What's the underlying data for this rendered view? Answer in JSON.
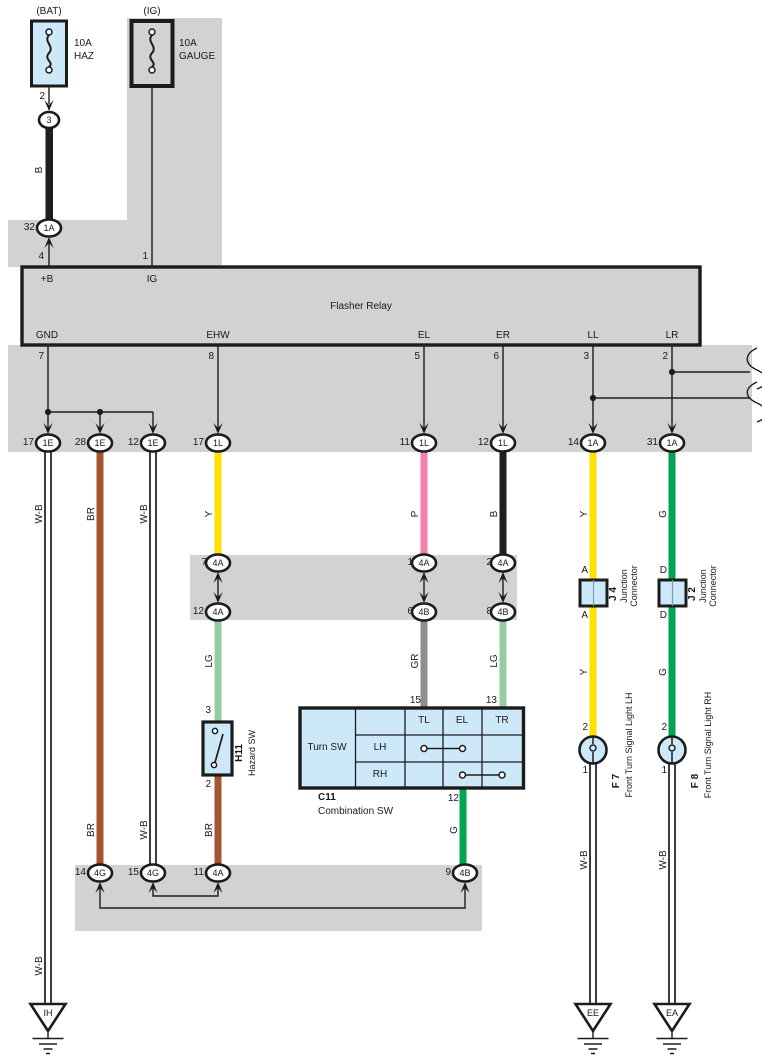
{
  "diagram": {
    "system": "Turn Signal and Hazard Warning wiring",
    "relay_title": "Flasher Relay"
  },
  "colors": {
    "panel": "#d2d2d2",
    "blue": "#cde9f9",
    "Y": "#ffe000",
    "P": "#f27fae",
    "B": "#1e1e1e",
    "BR": "#a4552d",
    "G": "#00a551",
    "LG": "#95cda1",
    "GR": "#8e8e8e"
  },
  "labels": [
    {
      "n": "fuse-bat-location",
      "t": "(BAT)",
      "x": 49,
      "y": 12
    },
    {
      "n": "fuse-ig-location",
      "t": "(IG)",
      "x": 152,
      "y": 12
    },
    {
      "n": "fuse-bat-rating",
      "t": "10A",
      "x": 74,
      "y": 44,
      "a": "s"
    },
    {
      "n": "fuse-bat-name",
      "t": "HAZ",
      "x": 74,
      "y": 57,
      "a": "s"
    },
    {
      "n": "fuse-ig-rating",
      "t": "10A",
      "x": 179,
      "y": 44,
      "a": "s"
    },
    {
      "n": "fuse-ig-name",
      "t": "GAUGE",
      "x": 179,
      "y": 57,
      "a": "s"
    },
    {
      "n": "pin-fuse-bat-2",
      "t": "2",
      "x": 45,
      "y": 97,
      "a": "e"
    },
    {
      "n": "conn-3-code",
      "t": "3",
      "x": 49,
      "y": 120,
      "fs": 9
    },
    {
      "n": "wire-b-label",
      "t": "B",
      "x": 40,
      "y": 170,
      "r": 1
    },
    {
      "n": "conn-1a-32-num",
      "t": "32",
      "x": 35,
      "y": 228,
      "a": "e"
    },
    {
      "n": "conn-1a-32-code",
      "t": "1A",
      "x": 49,
      "y": 228,
      "fs": 9
    },
    {
      "n": "pin-relay-4",
      "t": "4",
      "x": 44,
      "y": 257,
      "a": "e"
    },
    {
      "n": "pin-relay-1",
      "t": "1",
      "x": 148,
      "y": 257,
      "a": "e"
    },
    {
      "n": "relay-pin-plusb",
      "t": "+B",
      "x": 47,
      "y": 280
    },
    {
      "n": "relay-pin-ig",
      "t": "IG",
      "x": 152,
      "y": 280
    },
    {
      "n": "relay-title",
      "t": "Flasher Relay",
      "x": 361,
      "y": 307
    },
    {
      "n": "relay-pin-gnd",
      "t": "GND",
      "x": 47,
      "y": 336
    },
    {
      "n": "relay-pin-ehw",
      "t": "EHW",
      "x": 218,
      "y": 336
    },
    {
      "n": "relay-pin-el",
      "t": "EL",
      "x": 424,
      "y": 336
    },
    {
      "n": "relay-pin-er",
      "t": "ER",
      "x": 503,
      "y": 336
    },
    {
      "n": "relay-pin-ll",
      "t": "LL",
      "x": 593,
      "y": 336
    },
    {
      "n": "relay-pin-lr",
      "t": "LR",
      "x": 672,
      "y": 336
    },
    {
      "n": "pin-relay-7",
      "t": "7",
      "x": 44,
      "y": 357,
      "a": "e"
    },
    {
      "n": "pin-relay-8",
      "t": "8",
      "x": 214,
      "y": 357,
      "a": "e"
    },
    {
      "n": "pin-relay-5",
      "t": "5",
      "x": 420,
      "y": 357,
      "a": "e"
    },
    {
      "n": "pin-relay-6",
      "t": "6",
      "x": 499,
      "y": 357,
      "a": "e"
    },
    {
      "n": "pin-relay-3",
      "t": "3",
      "x": 589,
      "y": 357,
      "a": "e"
    },
    {
      "n": "pin-relay-2",
      "t": "2",
      "x": 668,
      "y": 357,
      "a": "e"
    },
    {
      "n": "conn-1e-17-num",
      "t": "17",
      "x": 34,
      "y": 443,
      "a": "e"
    },
    {
      "n": "conn-1e-17-code",
      "t": "1E",
      "x": 48,
      "y": 443,
      "fs": 9
    },
    {
      "n": "conn-1e-28-num",
      "t": "28",
      "x": 86,
      "y": 443,
      "a": "e"
    },
    {
      "n": "conn-1e-28-code",
      "t": "1E",
      "x": 100,
      "y": 443,
      "fs": 9
    },
    {
      "n": "conn-1e-12-num",
      "t": "12",
      "x": 139,
      "y": 443,
      "a": "e"
    },
    {
      "n": "conn-1e-12-code",
      "t": "1E",
      "x": 153,
      "y": 443,
      "fs": 9
    },
    {
      "n": "conn-1l-17-num",
      "t": "17",
      "x": 204,
      "y": 443,
      "a": "e"
    },
    {
      "n": "conn-1l-17-code",
      "t": "1L",
      "x": 218,
      "y": 443,
      "fs": 9
    },
    {
      "n": "conn-1l-11-num",
      "t": "11",
      "x": 410,
      "y": 443,
      "a": "e"
    },
    {
      "n": "conn-1l-11-code",
      "t": "1L",
      "x": 424,
      "y": 443,
      "fs": 9
    },
    {
      "n": "conn-1l-12-num",
      "t": "12",
      "x": 489,
      "y": 443,
      "a": "e"
    },
    {
      "n": "conn-1l-12-code",
      "t": "1L",
      "x": 503,
      "y": 443,
      "fs": 9
    },
    {
      "n": "conn-1a-14-num",
      "t": "14",
      "x": 579,
      "y": 443,
      "a": "e"
    },
    {
      "n": "conn-1a-14-code",
      "t": "1A",
      "x": 593,
      "y": 443,
      "fs": 9
    },
    {
      "n": "conn-1a-31-num",
      "t": "31",
      "x": 658,
      "y": 443,
      "a": "e"
    },
    {
      "n": "conn-1a-31-code",
      "t": "1A",
      "x": 672,
      "y": 443,
      "fs": 9
    },
    {
      "n": "wire-wb-label-1",
      "t": "W-B",
      "x": 40,
      "y": 514,
      "r": 1
    },
    {
      "n": "wire-br-label-1",
      "t": "BR",
      "x": 92,
      "y": 514,
      "r": 1
    },
    {
      "n": "wire-wb-label-2",
      "t": "W-B",
      "x": 145,
      "y": 514,
      "r": 1
    },
    {
      "n": "wire-y-label-1",
      "t": "Y",
      "x": 210,
      "y": 514,
      "r": 1
    },
    {
      "n": "wire-p-label",
      "t": "P",
      "x": 416,
      "y": 514,
      "r": 1
    },
    {
      "n": "wire-b2-label",
      "t": "B",
      "x": 495,
      "y": 514,
      "r": 1
    },
    {
      "n": "wire-y-label-2",
      "t": "Y",
      "x": 585,
      "y": 514,
      "r": 1
    },
    {
      "n": "wire-g-label-1",
      "t": "G",
      "x": 664,
      "y": 514,
      "r": 1
    },
    {
      "n": "conn-4a-7-num",
      "t": "7",
      "x": 207,
      "y": 563,
      "a": "e"
    },
    {
      "n": "conn-4a-7-code",
      "t": "4A",
      "x": 218,
      "y": 563,
      "fs": 9
    },
    {
      "n": "conn-4a-1-num",
      "t": "1",
      "x": 413,
      "y": 563,
      "a": "e"
    },
    {
      "n": "conn-4a-1-code",
      "t": "4A",
      "x": 424,
      "y": 563,
      "fs": 9
    },
    {
      "n": "conn-4a-2-num",
      "t": "2",
      "x": 492,
      "y": 563,
      "a": "e"
    },
    {
      "n": "conn-4a-2-code",
      "t": "4A",
      "x": 503,
      "y": 563,
      "fs": 9
    },
    {
      "n": "conn-4a-12-num",
      "t": "12",
      "x": 204,
      "y": 612,
      "a": "e"
    },
    {
      "n": "conn-4a-12-code",
      "t": "4A",
      "x": 218,
      "y": 612,
      "fs": 9
    },
    {
      "n": "conn-4b-6-num",
      "t": "6",
      "x": 413,
      "y": 612,
      "a": "e"
    },
    {
      "n": "conn-4b-6-code",
      "t": "4B",
      "x": 424,
      "y": 612,
      "fs": 9
    },
    {
      "n": "conn-4b-8-num",
      "t": "8",
      "x": 492,
      "y": 612,
      "a": "e"
    },
    {
      "n": "conn-4b-8-code",
      "t": "4B",
      "x": 503,
      "y": 612,
      "fs": 9
    },
    {
      "n": "wire-lg-label-1",
      "t": "LG",
      "x": 210,
      "y": 661,
      "r": 1
    },
    {
      "n": "wire-gr-label",
      "t": "GR",
      "x": 416,
      "y": 661,
      "r": 1
    },
    {
      "n": "wire-lg-label-2",
      "t": "LG",
      "x": 495,
      "y": 661,
      "r": 1
    },
    {
      "n": "pin-hazard-3",
      "t": "3",
      "x": 211,
      "y": 711,
      "a": "e"
    },
    {
      "n": "comp-hazard-code",
      "t": "H11",
      "x": 240,
      "y": 753,
      "r": 1,
      "b": 1
    },
    {
      "n": "comp-hazard-name",
      "t": "Hazard SW",
      "x": 252,
      "y": 753,
      "r": 1,
      "fs": 9
    },
    {
      "n": "pin-hazard-2",
      "t": "2",
      "x": 211,
      "y": 785,
      "a": "e"
    },
    {
      "n": "pin-combo-15",
      "t": "15",
      "x": 421,
      "y": 701,
      "a": "e"
    },
    {
      "n": "pin-combo-13",
      "t": "13",
      "x": 497,
      "y": 701,
      "a": "e"
    },
    {
      "n": "combo-turn-sw",
      "t": "Turn SW",
      "x": 327,
      "y": 748
    },
    {
      "n": "combo-col-tl",
      "t": "TL",
      "x": 424,
      "y": 721
    },
    {
      "n": "combo-col-el",
      "t": "EL",
      "x": 462,
      "y": 721
    },
    {
      "n": "combo-col-tr",
      "t": "TR",
      "x": 502,
      "y": 721
    },
    {
      "n": "combo-row-lh",
      "t": "LH",
      "x": 380,
      "y": 748
    },
    {
      "n": "combo-row-rh",
      "t": "RH",
      "x": 380,
      "y": 775
    },
    {
      "n": "comp-combo-code",
      "t": "C11",
      "x": 318,
      "y": 798,
      "a": "s",
      "b": 1
    },
    {
      "n": "comp-combo-name",
      "t": "Combination SW",
      "x": 318,
      "y": 812,
      "a": "s"
    },
    {
      "n": "pin-combo-12",
      "t": "12",
      "x": 459,
      "y": 799,
      "a": "e"
    },
    {
      "n": "wire-br-label-2",
      "t": "BR",
      "x": 92,
      "y": 830,
      "r": 1
    },
    {
      "n": "wire-wb-label-3",
      "t": "W-B",
      "x": 145,
      "y": 830,
      "r": 1
    },
    {
      "n": "wire-br-label-3",
      "t": "BR",
      "x": 210,
      "y": 830,
      "r": 1
    },
    {
      "n": "wire-g-label-2",
      "t": "G",
      "x": 455,
      "y": 830,
      "r": 1
    },
    {
      "n": "conn-4g-14-num",
      "t": "14",
      "x": 86,
      "y": 873,
      "a": "e"
    },
    {
      "n": "conn-4g-14-code",
      "t": "4G",
      "x": 100,
      "y": 873,
      "fs": 9
    },
    {
      "n": "conn-4g-15-num",
      "t": "15",
      "x": 139,
      "y": 873,
      "a": "e"
    },
    {
      "n": "conn-4g-15-code",
      "t": "4G",
      "x": 153,
      "y": 873,
      "fs": 9
    },
    {
      "n": "conn-4a-11-num",
      "t": "11",
      "x": 204,
      "y": 873,
      "a": "e"
    },
    {
      "n": "conn-4a-11-code",
      "t": "4A",
      "x": 218,
      "y": 873,
      "fs": 9
    },
    {
      "n": "conn-4b-9-num",
      "t": "9",
      "x": 451,
      "y": 873,
      "a": "e"
    },
    {
      "n": "conn-4b-9-code",
      "t": "4B",
      "x": 465,
      "y": 873,
      "fs": 9
    },
    {
      "n": "pin-j4-a-top",
      "t": "A",
      "x": 588,
      "y": 571,
      "a": "e"
    },
    {
      "n": "pin-j4-a-bottom",
      "t": "A",
      "x": 588,
      "y": 616,
      "a": "e"
    },
    {
      "n": "pin-j2-d-top",
      "t": "D",
      "x": 667,
      "y": 571,
      "a": "e"
    },
    {
      "n": "pin-j2-d-bottom",
      "t": "D",
      "x": 667,
      "y": 616,
      "a": "e"
    },
    {
      "n": "comp-j4-code",
      "t": "J 4",
      "x": 614,
      "y": 594,
      "r": 1,
      "b": 1
    },
    {
      "n": "comp-j4-name",
      "t": "Junction\nConnector",
      "x": 629,
      "y": 586,
      "r": 1,
      "fs": 9
    },
    {
      "n": "comp-j2-code",
      "t": "J 2",
      "x": 693,
      "y": 594,
      "r": 1,
      "b": 1
    },
    {
      "n": "comp-j2-name",
      "t": "Junction\nConnector",
      "x": 708,
      "y": 586,
      "r": 1,
      "fs": 9
    },
    {
      "n": "wire-y-label-3",
      "t": "Y",
      "x": 585,
      "y": 672,
      "r": 1
    },
    {
      "n": "wire-g-label-3",
      "t": "G",
      "x": 664,
      "y": 672,
      "r": 1
    },
    {
      "n": "pin-f7-2",
      "t": "2",
      "x": 588,
      "y": 728,
      "a": "e"
    },
    {
      "n": "pin-f7-1",
      "t": "1",
      "x": 588,
      "y": 771,
      "a": "e"
    },
    {
      "n": "pin-f8-2",
      "t": "2",
      "x": 667,
      "y": 728,
      "a": "e"
    },
    {
      "n": "pin-f8-1",
      "t": "1",
      "x": 667,
      "y": 771,
      "a": "e"
    },
    {
      "n": "comp-f7-code",
      "t": "F 7",
      "x": 617,
      "y": 781,
      "r": 1,
      "b": 1
    },
    {
      "n": "comp-f7-name",
      "t": "Front Turn Signal Light LH",
      "x": 629,
      "y": 745,
      "r": 1,
      "fs": 9
    },
    {
      "n": "comp-f8-code",
      "t": "F 8",
      "x": 696,
      "y": 781,
      "r": 1,
      "b": 1
    },
    {
      "n": "comp-f8-name",
      "t": "Front Turn Signal Light RH",
      "x": 708,
      "y": 745,
      "r": 1,
      "fs": 9
    },
    {
      "n": "wire-wb-label-4",
      "t": "W-B",
      "x": 585,
      "y": 860,
      "r": 1
    },
    {
      "n": "wire-wb-label-5",
      "t": "W-B",
      "x": 664,
      "y": 860,
      "r": 1
    },
    {
      "n": "wire-wb-label-6",
      "t": "W-B",
      "x": 40,
      "y": 966,
      "r": 1
    },
    {
      "n": "ground-ih-label",
      "t": "IH",
      "x": 48,
      "y": 1013,
      "fs": 9
    },
    {
      "n": "ground-ee-label",
      "t": "EE",
      "x": 593,
      "y": 1013,
      "fs": 9
    },
    {
      "n": "ground-ea-label",
      "t": "EA",
      "x": 672,
      "y": 1013,
      "fs": 9
    }
  ]
}
